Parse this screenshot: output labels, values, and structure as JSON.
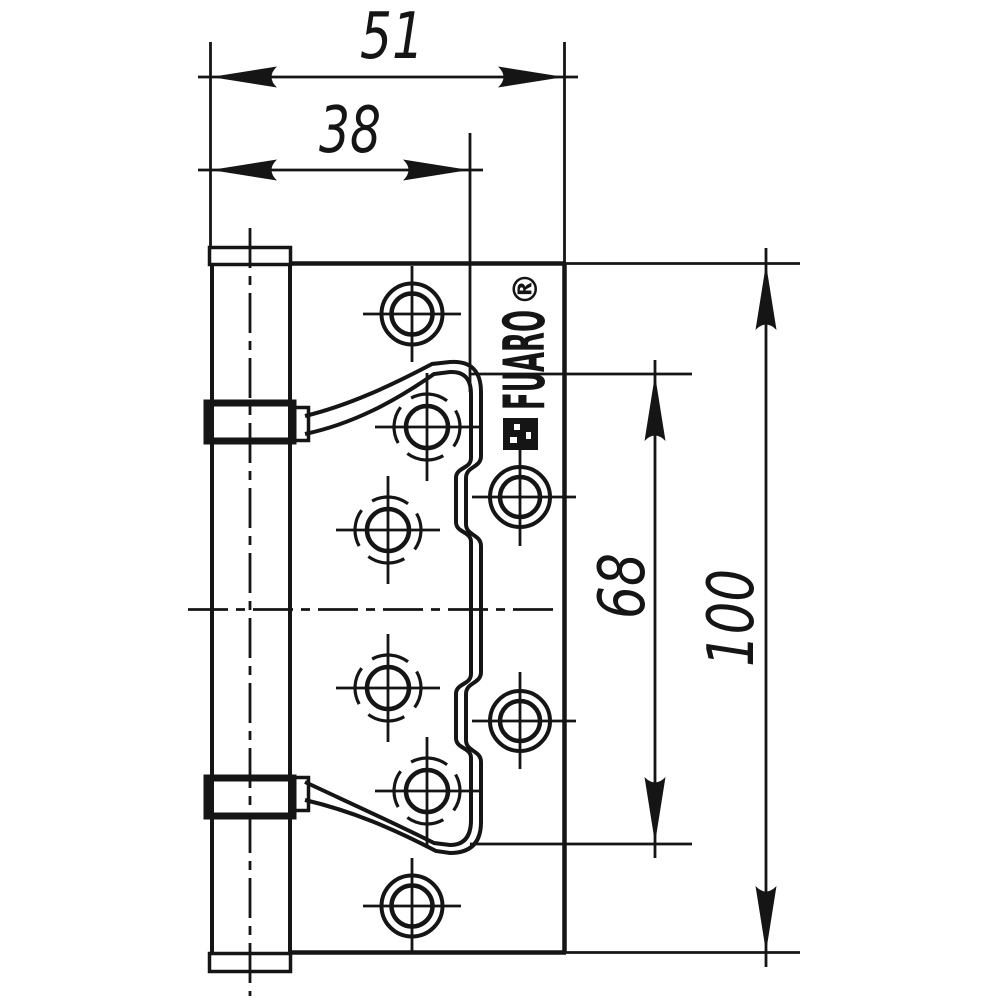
{
  "drawing": {
    "background_color": "#ffffff",
    "line_color": "#151515",
    "brand": {
      "name": "FUARO",
      "registered_mark": "®"
    },
    "dimensions": {
      "overall_width": "51",
      "leaf_width": "38",
      "inner_height": "68",
      "overall_height": "100"
    }
  }
}
